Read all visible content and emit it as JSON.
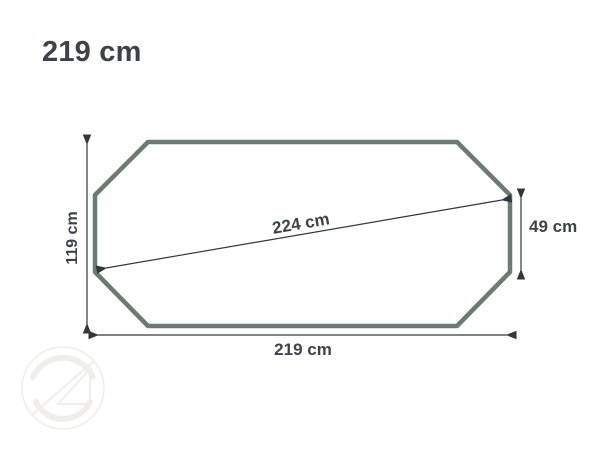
{
  "title": "219 cm",
  "dimensions": {
    "width_label": "219 cm",
    "height_label": "119 cm",
    "diagonal_label": "224 cm",
    "side_label": "49 cm"
  },
  "colors": {
    "outline": "#6b7a73",
    "dimension_line": "#33383d",
    "text": "#3c434a",
    "watermark": "#efeeec",
    "background": "#ffffff"
  }
}
